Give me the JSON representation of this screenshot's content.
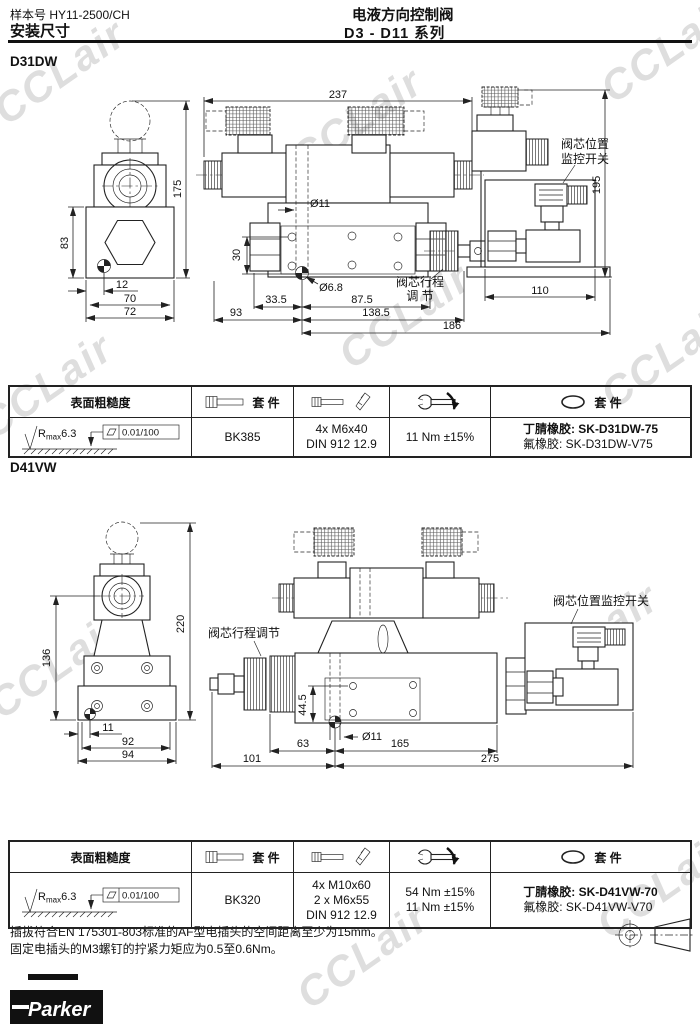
{
  "watermark": {
    "text": "CCLair"
  },
  "header": {
    "catalog": "样本号 HY11-2500/CH",
    "subject": "安装尺寸",
    "title": "电液方向控制阀",
    "series": "D3 - D11 系列"
  },
  "d31dw": {
    "title": "D31DW",
    "dims": {
      "f175": "175",
      "f83": "83",
      "f12": "12",
      "f70": "70",
      "f72": "72",
      "s237": "237",
      "sO11": "Ø11",
      "s30": "30",
      "sO68": "Ø6.8",
      "s335": "33.5",
      "s93": "93",
      "s875": "87.5",
      "s1385": "138.5",
      "s186": "186",
      "r195": "195",
      "r110": "110"
    },
    "labels": {
      "monitor1": "阀芯位置",
      "monitor2": "监控开关",
      "stroke1": "阀芯行程",
      "stroke2": "调 节"
    }
  },
  "d41vw": {
    "title": "D41VW",
    "dims": {
      "f136": "136",
      "f220": "220",
      "f11": "11",
      "f92": "92",
      "f94": "94",
      "s445": "44.5",
      "sO11": "Ø11",
      "s63": "63",
      "s165": "165",
      "s101": "101",
      "s275": "275"
    },
    "labels": {
      "stroke": "阀芯行程调节",
      "monitor": "阀芯位置监控开关"
    }
  },
  "tables": [
    {
      "headers": {
        "roughness": "表面粗糙度",
        "bolt_kit": "套 件",
        "seal_kit": "套 件"
      },
      "roughness": {
        "r": "R",
        "max": "max",
        "value": "6.3",
        "flatness": "0.01/100"
      },
      "bolt_kit": "BK385",
      "screws": [
        "4x M6x40",
        "DIN 912 12.9"
      ],
      "torques": [
        "11 Nm ±15%"
      ],
      "seals": [
        "丁腈橡胶: SK-D31DW-75",
        "氟橡胶: SK-D31DW-V75"
      ]
    },
    {
      "headers": {
        "roughness": "表面粗糙度",
        "bolt_kit": "套 件",
        "seal_kit": "套 件"
      },
      "roughness": {
        "r": "R",
        "max": "max",
        "value": "6.3",
        "flatness": "0.01/100"
      },
      "bolt_kit": "BK320",
      "screws": [
        "4x M10x60",
        "2 x M6x55",
        "DIN 912 12.9"
      ],
      "torques": [
        "54 Nm ±15%",
        "11 Nm ±15%"
      ],
      "seals": [
        "丁腈橡胶: SK-D41VW-70",
        "氟橡胶: SK-D41VW-V70"
      ]
    }
  ],
  "notes": [
    "插拔符合EN 175301-803标准的AF型电插头的空间距离至少为15mm。",
    "固定电插头的M3螺钉的拧紧力矩应为0.5至0.6Nm。"
  ],
  "logo": {
    "brand": "Parker"
  }
}
